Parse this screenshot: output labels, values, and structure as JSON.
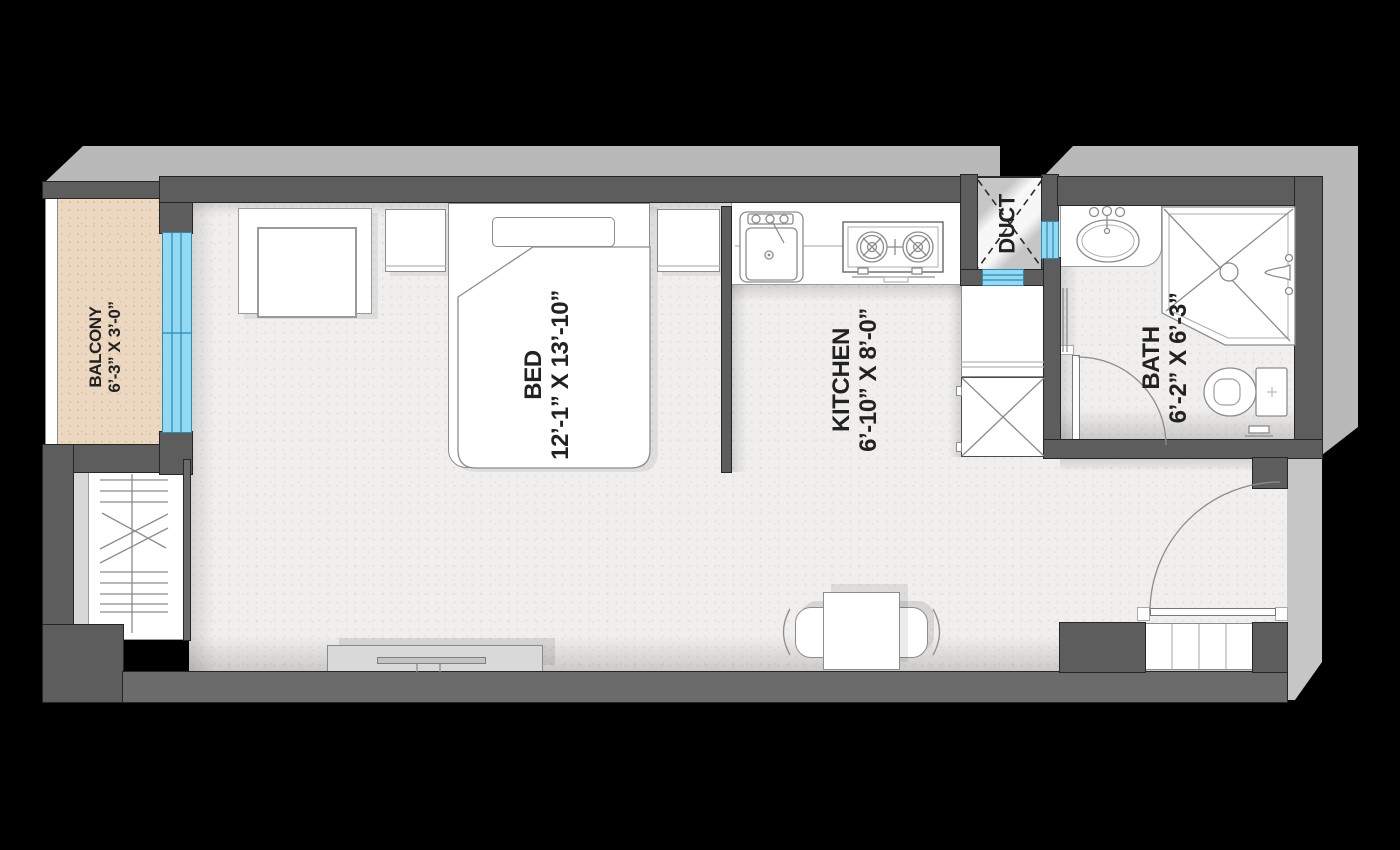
{
  "rooms": {
    "balcony": {
      "name": "BALCONY",
      "dims": "6’-3” X 3’-0”"
    },
    "bed": {
      "name": "BED",
      "dims": "12’-1” X 13’-10”"
    },
    "kitchen": {
      "name": "KITCHEN",
      "dims": "6’-10” X 8’-0”"
    },
    "duct": {
      "name": "DUCT"
    },
    "bath": {
      "name": "BATH",
      "dims": "6’-2” X 6’-3”"
    }
  },
  "colors": {
    "background": "#000000",
    "wall": "#5d5d5d",
    "wall_edge": "#262626",
    "floor": "#f0efed",
    "balcony_floor": "#ecd8c1",
    "glass": "#92d9f3",
    "glass_line": "#2d89ad",
    "extrusion": "#b9b9b9",
    "furniture_line": "#8c8c8c",
    "label_text": "#222222"
  }
}
